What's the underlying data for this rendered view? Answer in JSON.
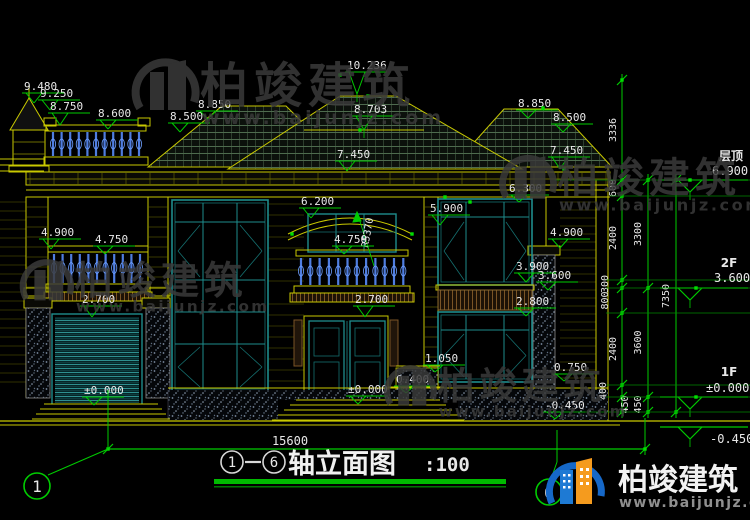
{
  "colors": {
    "background": "#000000",
    "wall_yellow": "#c9c900",
    "dim_green": "#00cc00",
    "bright_green": "#00e000",
    "window_teal": "#1e8c8c",
    "baluster_blue": "#4f7de0",
    "text_white": "#e8e8e8",
    "watermark_gray": "#3a3a3a",
    "logo_blue": "#1668c8",
    "logo_orange": "#f59b1e",
    "band_brown": "#8a6a30"
  },
  "watermark": {
    "brand": "柏竣建筑",
    "url": "www.baijunjz.com"
  },
  "brand_footer": {
    "brand": "柏竣建筑",
    "url": "www.baijunjz.com"
  },
  "title_bar": {
    "axis_start": "1",
    "axis_end": "6",
    "title": "轴立面图",
    "scale": ":100"
  },
  "overall_width_dim": "15600",
  "axis_bubbles": {
    "left": "1",
    "right": "6"
  },
  "levels": {
    "roof_label": "层顶",
    "roof_value": "6.900",
    "f2_label": "2F",
    "f2_value": "3.600",
    "f1_label": "1F",
    "f1_value": "±0.000",
    "ground_value": "-0.450"
  },
  "radius_annotation": "R5370",
  "elevation_markers": [
    {
      "value": "9.480",
      "x": 22,
      "y": 90,
      "drop": 10
    },
    {
      "value": "9.250",
      "x": 38,
      "y": 97,
      "drop": 10
    },
    {
      "value": "8.750",
      "x": 48,
      "y": 110,
      "drop": 12
    },
    {
      "value": "8.600",
      "x": 96,
      "y": 117,
      "drop": 9
    },
    {
      "value": "8.500",
      "x": 168,
      "y": 120,
      "drop": 9
    },
    {
      "value": "8.850",
      "x": 196,
      "y": 108,
      "drop": 8
    },
    {
      "value": "10.236",
      "x": 345,
      "y": 69,
      "drop": 22
    },
    {
      "value": "8.703",
      "x": 352,
      "y": 113,
      "drop": 14
    },
    {
      "value": "7.450",
      "x": 335,
      "y": 158,
      "drop": 10
    },
    {
      "value": "8.850",
      "x": 516,
      "y": 107,
      "drop": 8
    },
    {
      "value": "8.500",
      "x": 551,
      "y": 121,
      "drop": 8
    },
    {
      "value": "7.450",
      "x": 548,
      "y": 154,
      "drop": 12
    },
    {
      "value": "6.300",
      "x": 507,
      "y": 192,
      "drop": 7
    },
    {
      "value": "6.200",
      "x": 299,
      "y": 205,
      "drop": 10
    },
    {
      "value": "5.900",
      "x": 428,
      "y": 212,
      "drop": 10
    },
    {
      "value": "4.900",
      "x": 39,
      "y": 236,
      "drop": 10
    },
    {
      "value": "4.750",
      "x": 93,
      "y": 243,
      "drop": 8
    },
    {
      "value": "4.750",
      "x": 332,
      "y": 243,
      "drop": 8
    },
    {
      "value": "4.900",
      "x": 548,
      "y": 236,
      "drop": 9
    },
    {
      "value": "3.900",
      "x": 514,
      "y": 270,
      "drop": 9
    },
    {
      "value": "3.600",
      "x": 536,
      "y": 279,
      "drop": 8
    },
    {
      "value": "2.800",
      "x": 514,
      "y": 305,
      "drop": 8
    },
    {
      "value": "2.700",
      "x": 80,
      "y": 303,
      "drop": 11
    },
    {
      "value": "2.700",
      "x": 353,
      "y": 303,
      "drop": 11
    },
    {
      "value": "1.050",
      "x": 423,
      "y": 362,
      "drop": 7
    },
    {
      "value": "0.750",
      "x": 552,
      "y": 371,
      "drop": 7
    },
    {
      "value": "0.400",
      "x": 394,
      "y": 383,
      "drop": 7
    },
    {
      "value": "±0.000",
      "x": 82,
      "y": 394,
      "drop": 8
    },
    {
      "value": "±0.000",
      "x": 346,
      "y": 393,
      "drop": 8
    },
    {
      "value": "-0.450",
      "x": 543,
      "y": 409,
      "drop": 7
    }
  ],
  "dim_chains": {
    "inner": [
      "3336",
      "600",
      "2400",
      "300",
      "800",
      "2400",
      "400",
      "450"
    ],
    "middle": [
      "3300",
      "3600",
      "450"
    ],
    "outer": [
      "7350"
    ]
  }
}
